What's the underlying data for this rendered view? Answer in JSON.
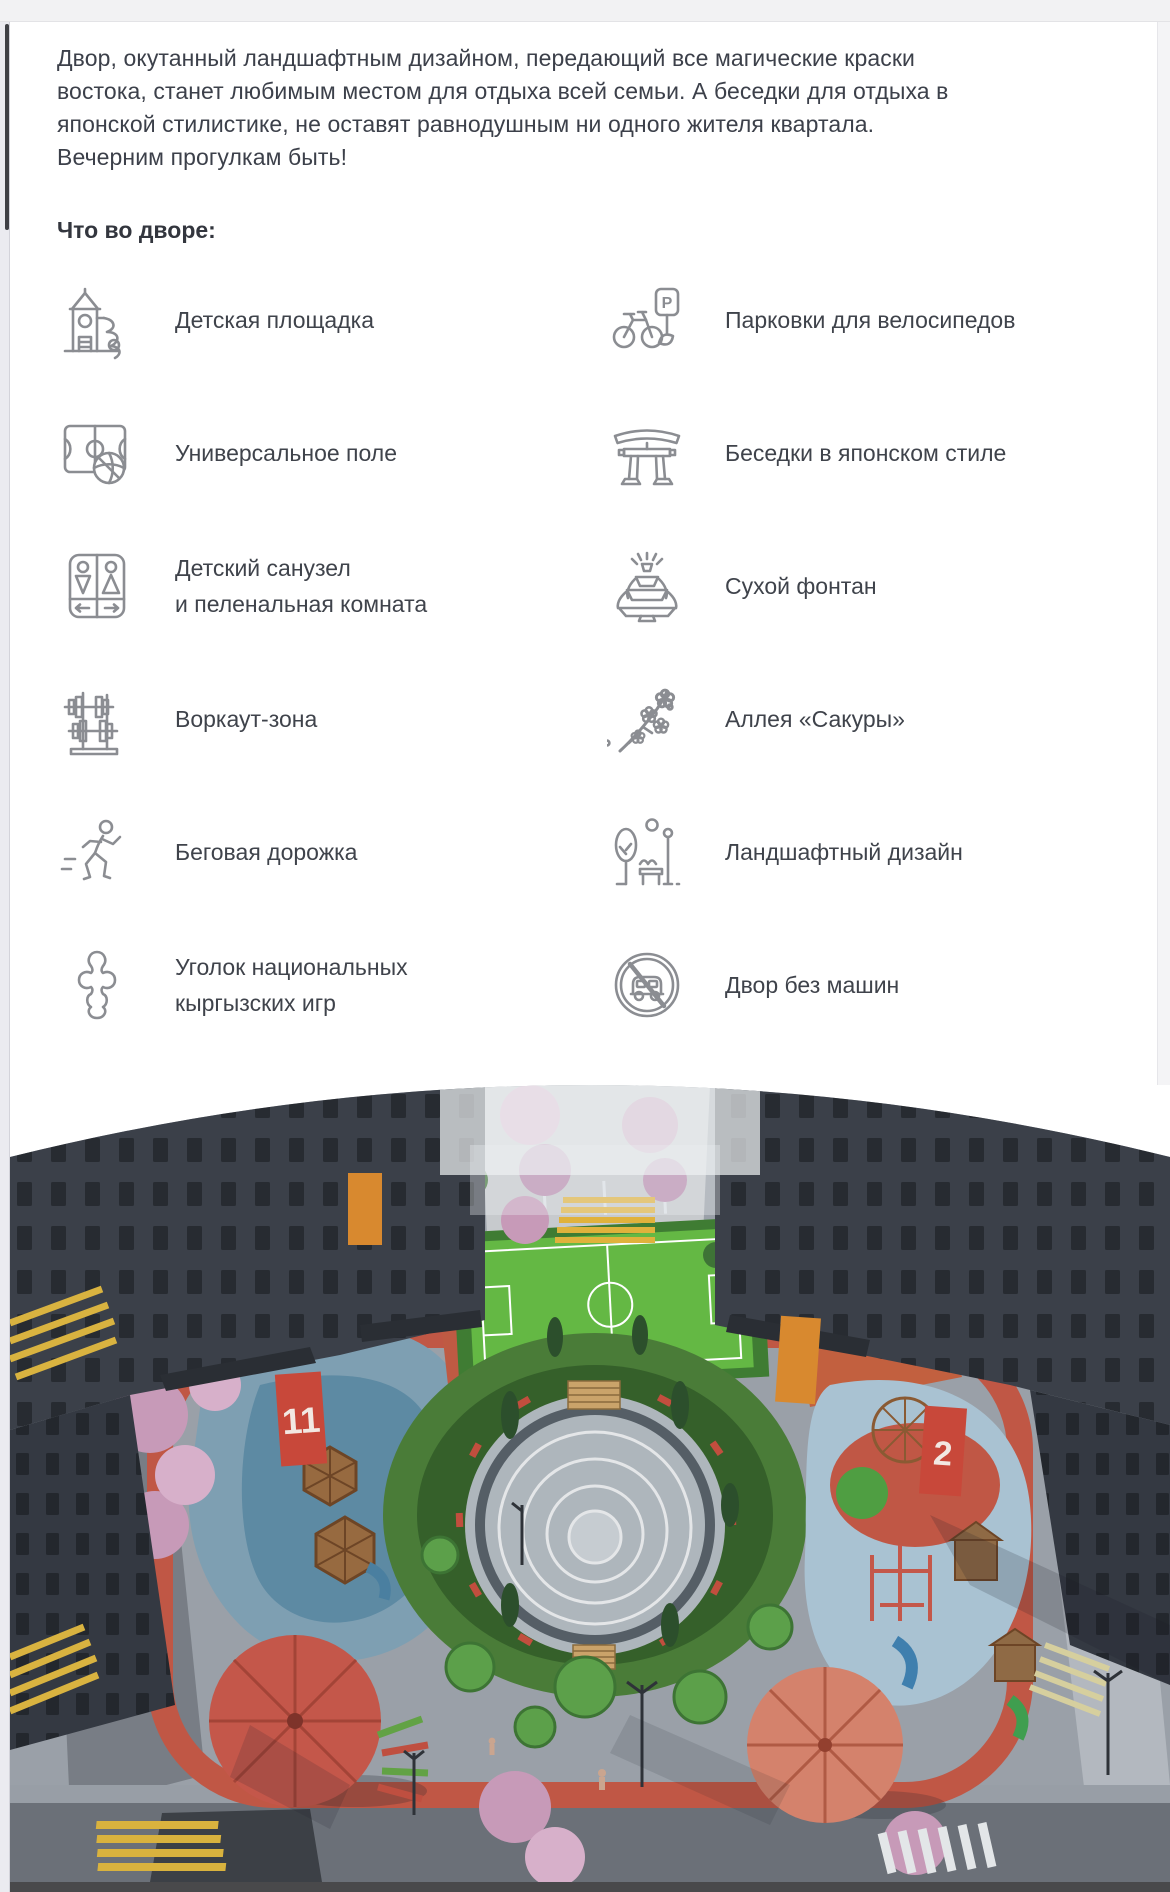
{
  "colors": {
    "text": "#3c404a",
    "icon_stroke": "#8b8d92",
    "topbar": "#f2f2f3",
    "photo_bottom_bar": "#49494b"
  },
  "intro": {
    "paragraph": "Двор, окутанный ландшафтным дизайном, передающий все магические краски\nвостока, станет любимым местом для отдыха всей семьи. А беседки для отдыха в\nяпонской стилистике, не оставят равнодушным ни одного жителя квартала.\nВечерним прогулкам быть!"
  },
  "section": {
    "heading": "Что во дворе:"
  },
  "features": [
    {
      "name": "playground",
      "label": "Детская площадка"
    },
    {
      "name": "bike-parking",
      "label": "Парковки для велосипедов"
    },
    {
      "name": "sports-field",
      "label": "Универсальное поле"
    },
    {
      "name": "japanese-gazebo",
      "label": "Беседки в японском стиле"
    },
    {
      "name": "kids-wc",
      "label": "Детский санузел\nи пеленальная комната"
    },
    {
      "name": "dry-fountain",
      "label": "Сухой фонтан"
    },
    {
      "name": "workout",
      "label": "Воркаут-зона"
    },
    {
      "name": "sakura-alley",
      "label": "Аллея «Сакуры»"
    },
    {
      "name": "running-track",
      "label": "Беговая дорожка"
    },
    {
      "name": "landscape-design",
      "label": "Ландшафтный дизайн"
    },
    {
      "name": "kyrgyz-games",
      "label": "Уголок национальных\nкыргызских игр"
    },
    {
      "name": "no-cars",
      "label": "Двор без машин"
    }
  ],
  "icons": {
    "bike_sign_letter": "P"
  },
  "photo": {
    "building_sign_left": "11",
    "building_sign_right": "2"
  }
}
